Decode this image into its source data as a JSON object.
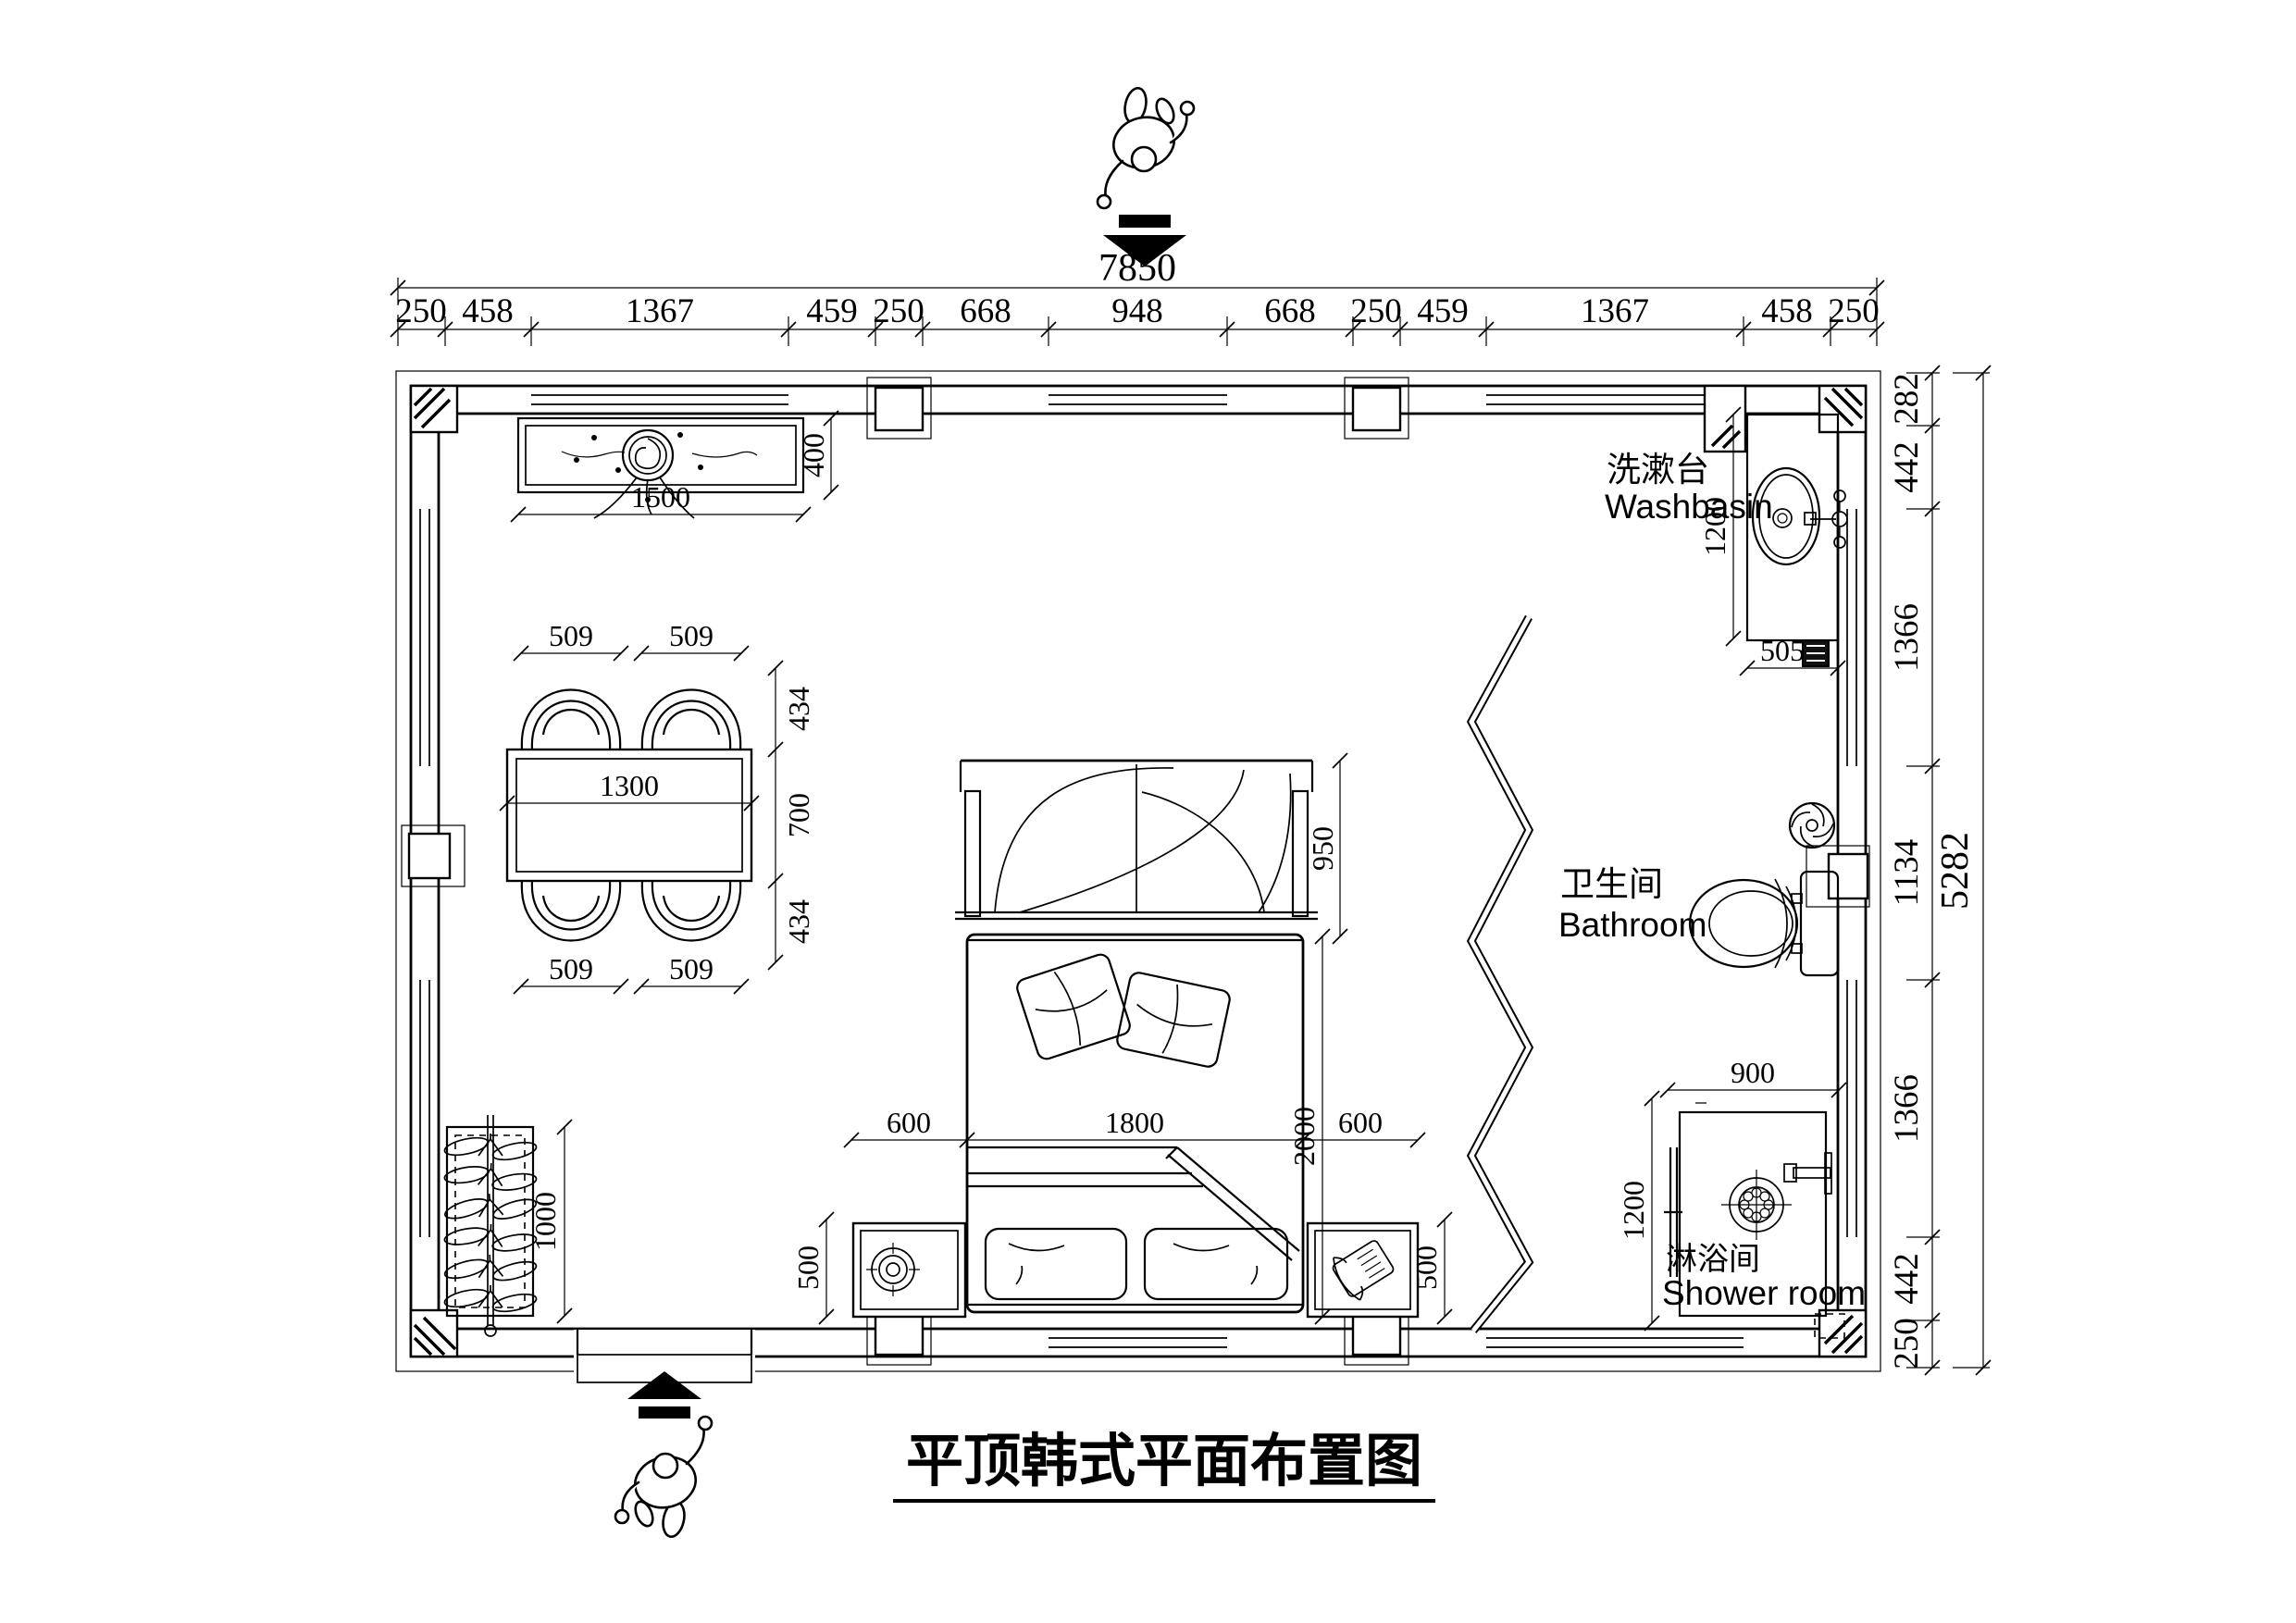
{
  "title": {
    "text": "平顶韩式平面布置图"
  },
  "dims_top": {
    "total": "7850",
    "chain": [
      "250",
      "458",
      "1367",
      "459",
      "250",
      "668",
      "948",
      "668",
      "250",
      "459",
      "1367",
      "458",
      "250"
    ]
  },
  "dims_right": {
    "total": "5282",
    "chain": [
      "282",
      "442",
      "1366",
      "1134",
      "1366",
      "442",
      "250"
    ]
  },
  "rooms": {
    "washbasin": {
      "zh": "洗漱台",
      "en": "Washbasin"
    },
    "bathroom": {
      "zh": "卫生间",
      "en": "Bathroom"
    },
    "shower": {
      "zh": "淋浴间",
      "en": "Shower room"
    }
  },
  "furniture": {
    "ceiling_lamp": {
      "width": "1500",
      "depth": "400"
    },
    "dining": {
      "table_width": "1300",
      "table_depth": "700",
      "chair_width_tl": "509",
      "chair_width_tr": "509",
      "chair_width_bl": "509",
      "chair_width_br": "509",
      "chair_depth_top": "434",
      "chair_depth_bottom": "434"
    },
    "clothes_rack": {
      "length": "1000"
    },
    "bed": {
      "canopy_depth": "950",
      "width": "1800",
      "length": "2000",
      "left_gap": "600",
      "right_gap": "600"
    },
    "nightstand_left": {
      "depth": "500"
    },
    "nightstand_right": {
      "depth": "500"
    },
    "washbasin_counter": {
      "depth": "1200",
      "width": "505"
    },
    "shower_cabin": {
      "width": "900",
      "depth": "1200"
    }
  },
  "colors": {
    "ink": "#000000",
    "background": "#ffffff"
  }
}
